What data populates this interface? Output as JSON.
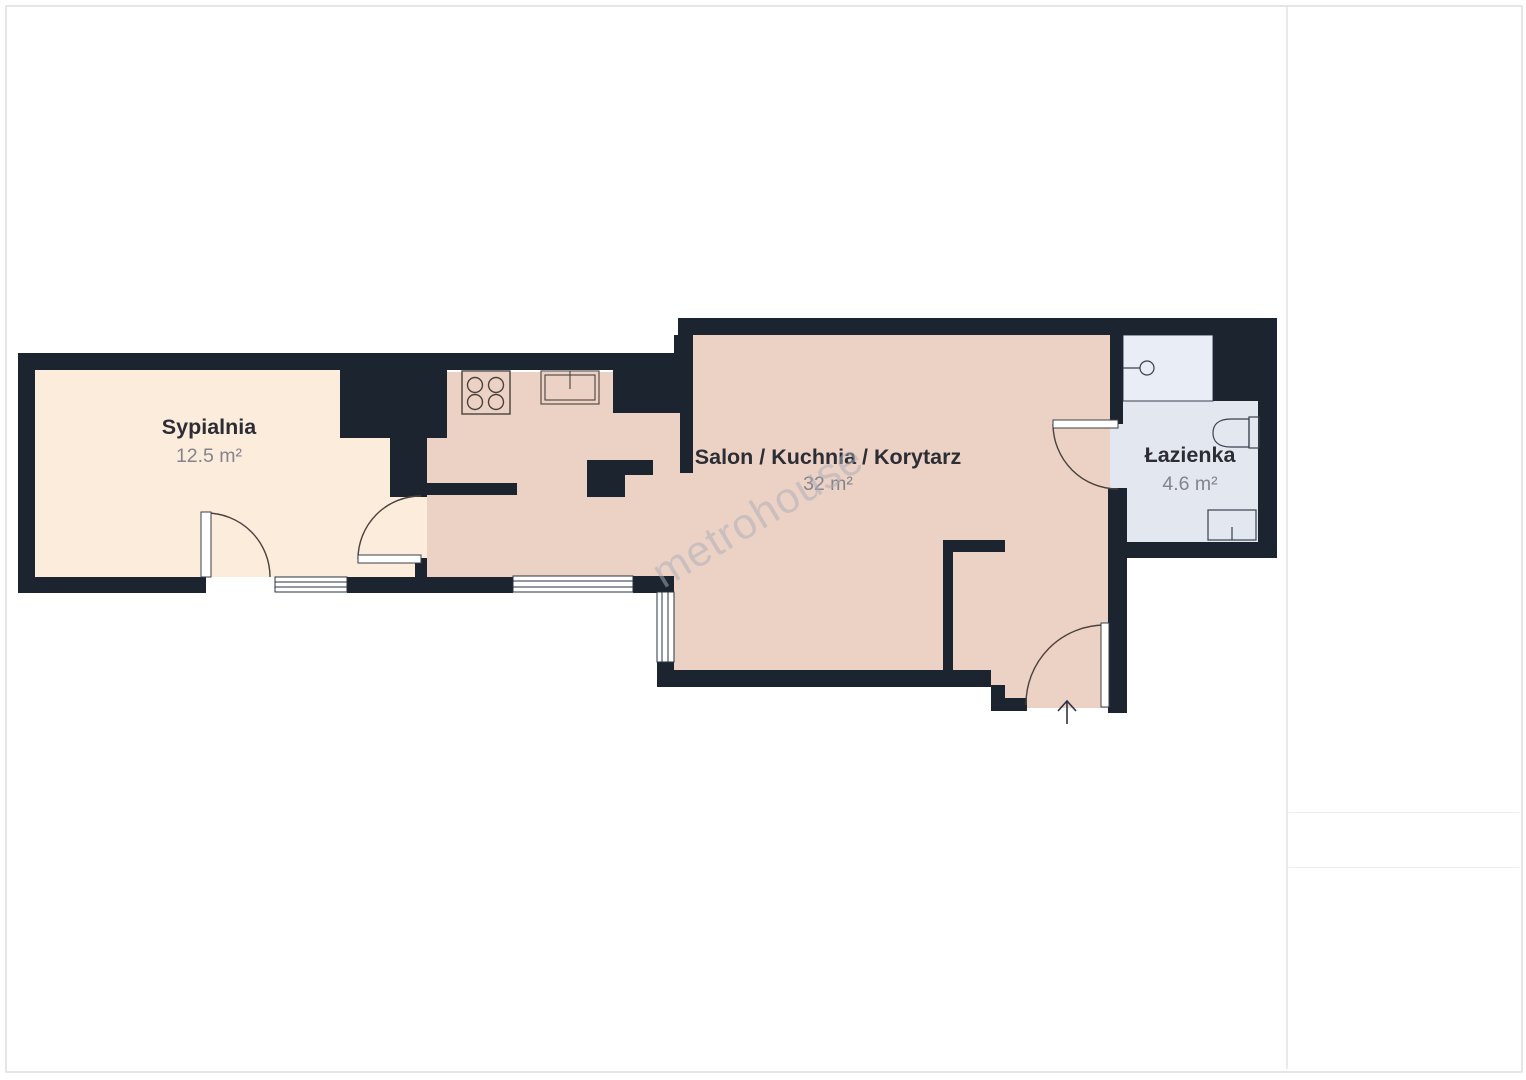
{
  "floor_plan": {
    "watermark": "metrohouse",
    "rooms": [
      {
        "name": "Sypialnia",
        "area": "12.5 m²"
      },
      {
        "name": "Salon / Kuchnia / Korytarz",
        "area": "32 m²"
      },
      {
        "name": "Łazienka",
        "area": "4.6 m²"
      }
    ]
  },
  "sidebar": {
    "title": "Przybliżona całkowita powierzchnia",
    "title_superscript": "(1)",
    "total_area": "49.1 m²",
    "footnote": "(1) Z wyłączeniem balkonów i tarasów",
    "disclaimer": "Pomimo wszelkich starań, aby zapewnić dokładność, wszystkie pomiary są przybliżone i nie są w skali. Ten plan piętra ma charakter poglądowy.",
    "standard_note": "Obliczenia są oparte na standardzie RICS IPMS 3C.",
    "logo": {
      "brand": "GIRAFFE",
      "suffix": "360"
    }
  },
  "colors": {
    "wall": "#1c2430",
    "bedroom_floor": "#fcecdb",
    "living_floor": "#ecd2c4",
    "bathroom_floor": "#e2e7f0",
    "shower_floor": "#e9edf5",
    "room_label": "#2d2d35",
    "area_label": "#84848d",
    "sidebar_title": "#3d4960",
    "sidebar_text": "#6e7480",
    "divider": "#e9e9ee"
  }
}
